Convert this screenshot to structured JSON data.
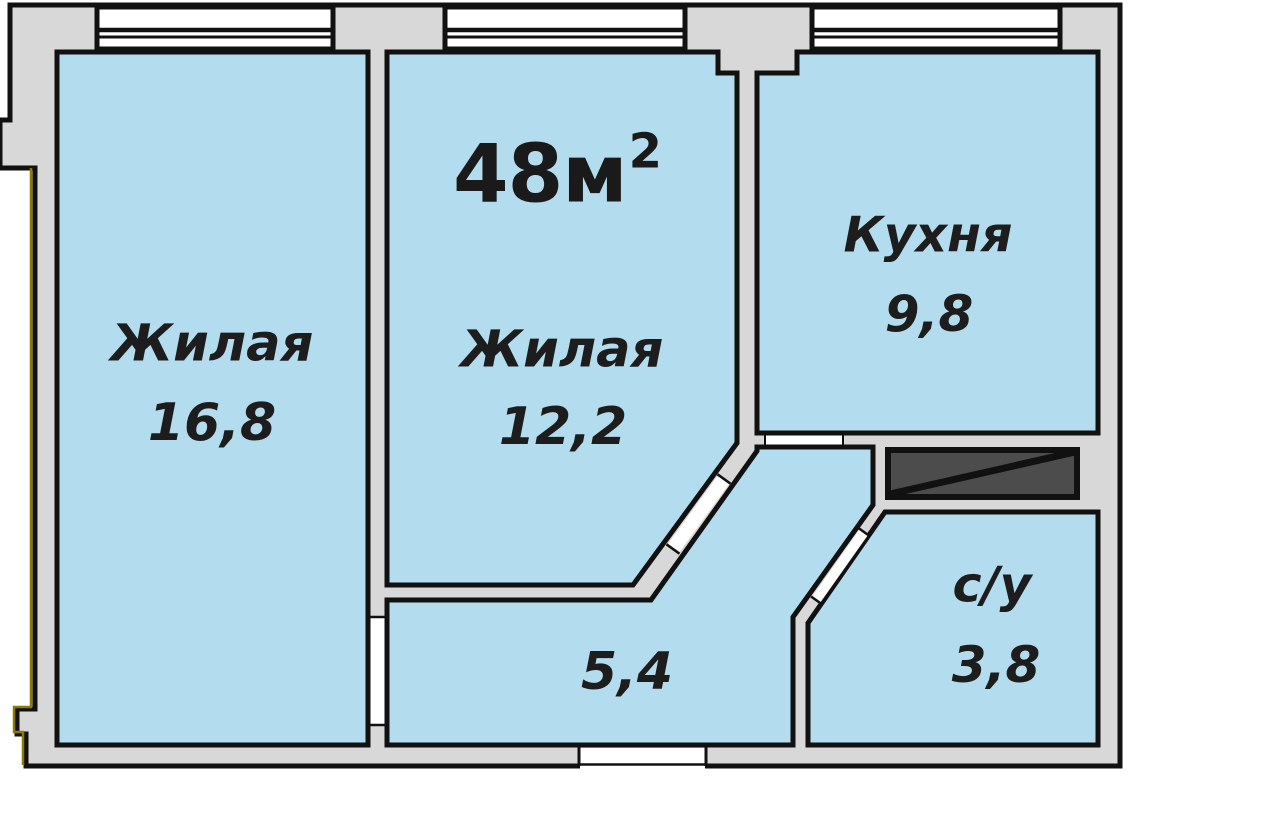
{
  "plan": {
    "title": {
      "area_value": "48м",
      "superscript": "2"
    },
    "rooms": [
      {
        "key": "living-1",
        "label": "Жилая",
        "area": "16,8"
      },
      {
        "key": "living-2",
        "label": "Жилая",
        "area": "12,2"
      },
      {
        "key": "kitchen",
        "label": "Кухня",
        "area": "9,8"
      },
      {
        "key": "bathroom",
        "label": "с/у",
        "area": "3,8"
      },
      {
        "key": "hallway",
        "label": "",
        "area": "5,4"
      }
    ],
    "colors": {
      "floor": "#b3ddee",
      "wall": "#d8d8d8",
      "outline": "#111111",
      "shaft": "#4c4c4c",
      "accent": "#8f7a00"
    }
  }
}
